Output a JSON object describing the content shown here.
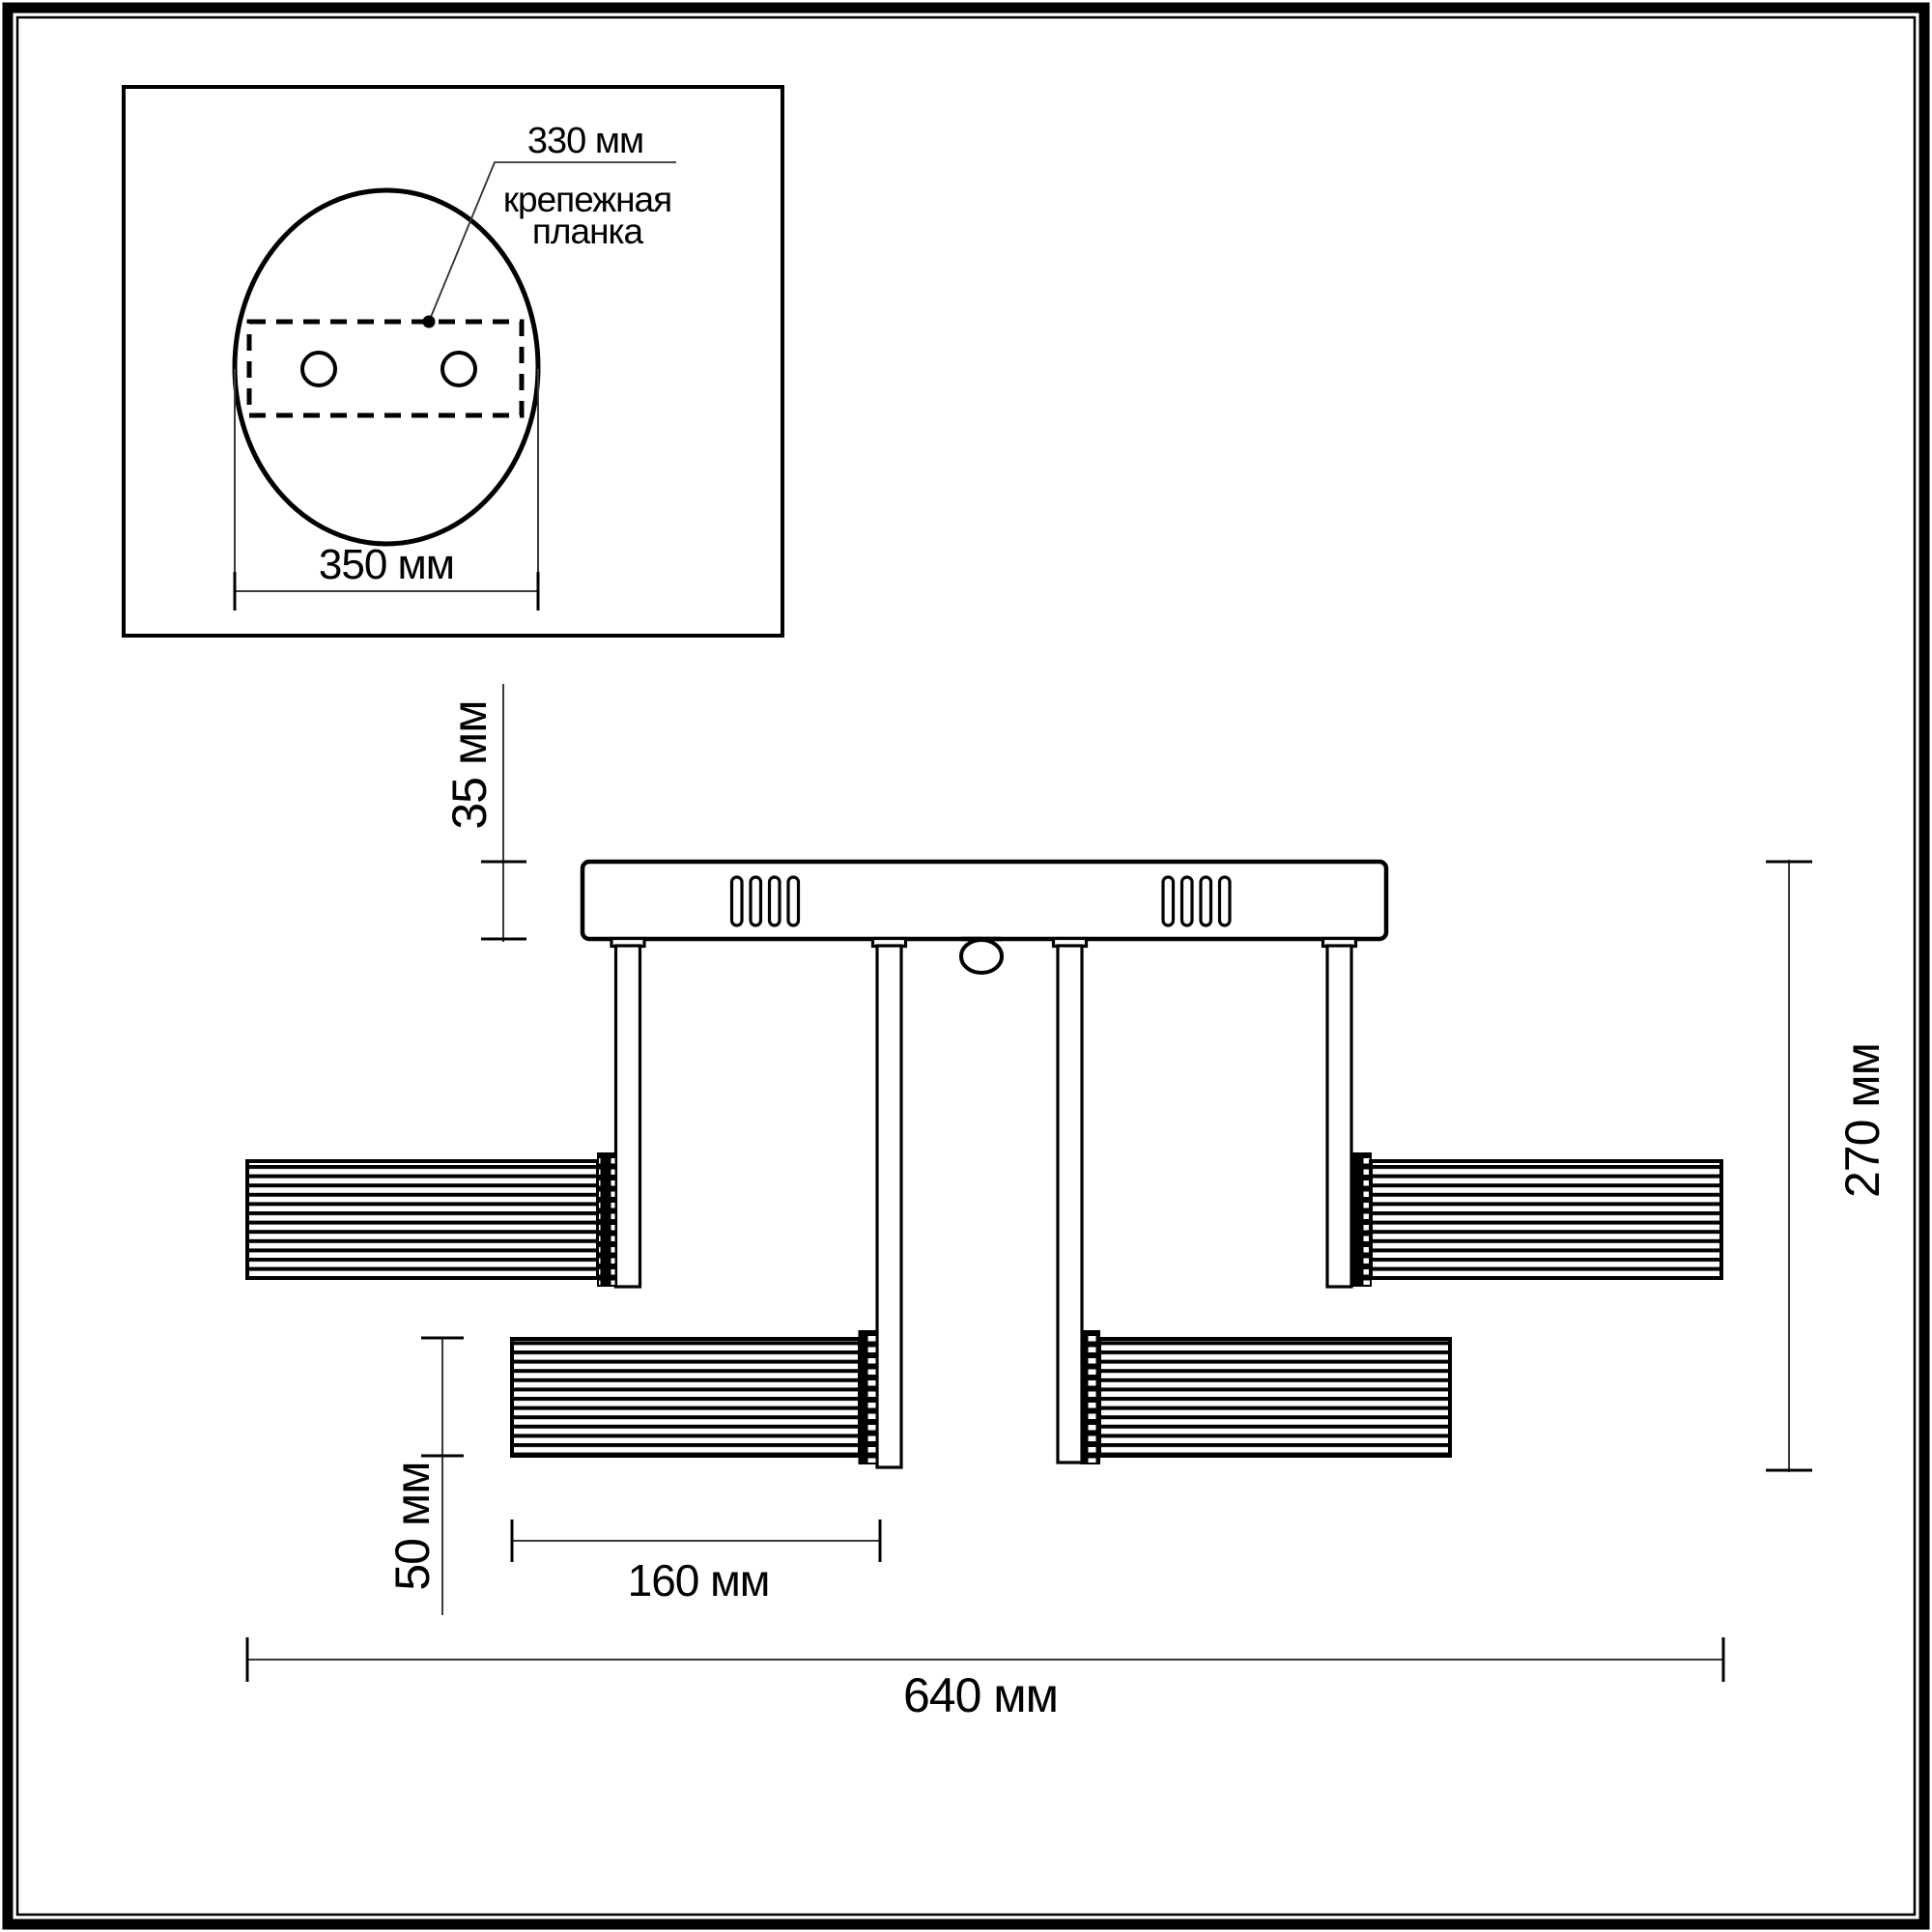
{
  "drawing": {
    "type": "technical-dimensional-drawing",
    "subject": "ceiling-light-fixture",
    "units": "мм",
    "colors": {
      "line": "#000000",
      "dimension_line": "#3a3a3a",
      "background": "#ffffff"
    },
    "inset": {
      "plate_width_label": "330 мм",
      "plate_name_line1": "крепежная",
      "plate_name_line2": "планка",
      "canopy_diameter_label": "350 мм",
      "screw_holes": 2
    },
    "main": {
      "canopy_height_label": "35 мм",
      "fixture_height_label": "270 мм",
      "shade_diameter_label": "50 мм",
      "shade_length_label": "160 мм",
      "fixture_width_label": "640 мм",
      "shade_count": 4,
      "rod_count": 4
    }
  }
}
